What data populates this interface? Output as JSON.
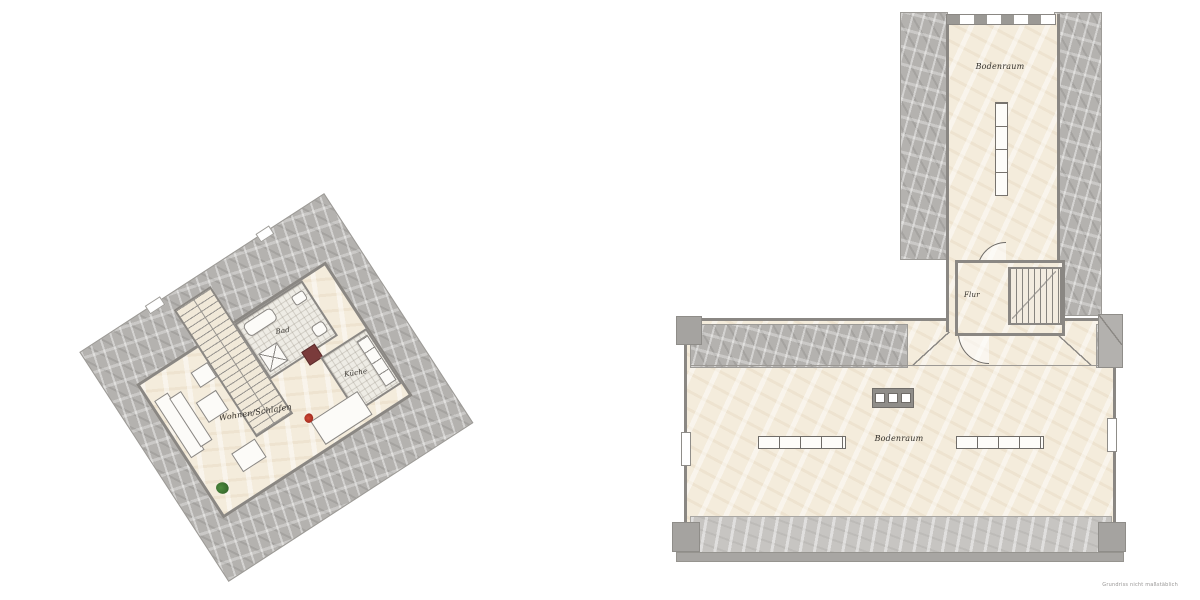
{
  "caption": "Grundriss nicht maßstäblich",
  "left_plan": {
    "name": "attic apartment floor plan (rotated)",
    "rotation": "-33deg",
    "rooms": {
      "bad": "Bad",
      "kueche": "Küche",
      "wohnen_schlafen": "Wohnen/Schlafen"
    }
  },
  "right_plan": {
    "name": "attic storage floor plan",
    "rooms": {
      "bodenraum_top": "Bodenraum",
      "flur": "Flur",
      "bodenraum_main": "Bodenraum"
    }
  },
  "colors": {
    "floor_cream": "#f4ecdc",
    "floor_tile": "#eeece5",
    "roof_hatch": "#b4b2af",
    "roof_hatch_light": "#c7c5c2",
    "wall": "#8a8783",
    "chimney_red": "#7a3b3b",
    "plant_green": "#3e7a33",
    "flowers_red": "#c0392b"
  }
}
